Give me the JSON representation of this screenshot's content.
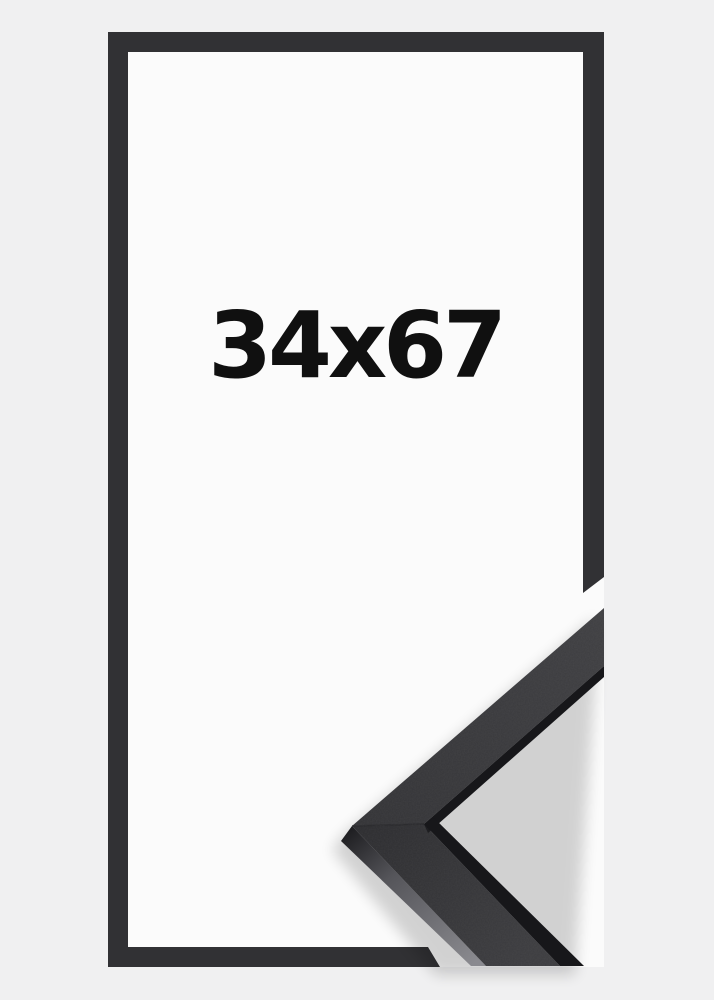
{
  "product": {
    "size_label": "34x67",
    "colors": {
      "background": "#f0f0f1",
      "paper": "#fbfbfb",
      "frame_outline": "#313134",
      "face_light": "#3f3f42",
      "face_mid": "#333336",
      "face_deep": "#2c2c2f",
      "face_low_end": "#3c3c3f",
      "edge_dark": "#17171a",
      "side_shade_dark": "#1d1d20",
      "side_shade_mid": "#55555a",
      "side_shade_light": "#8a8a8f",
      "label_text": "#101010",
      "shadow": "#000000"
    }
  }
}
